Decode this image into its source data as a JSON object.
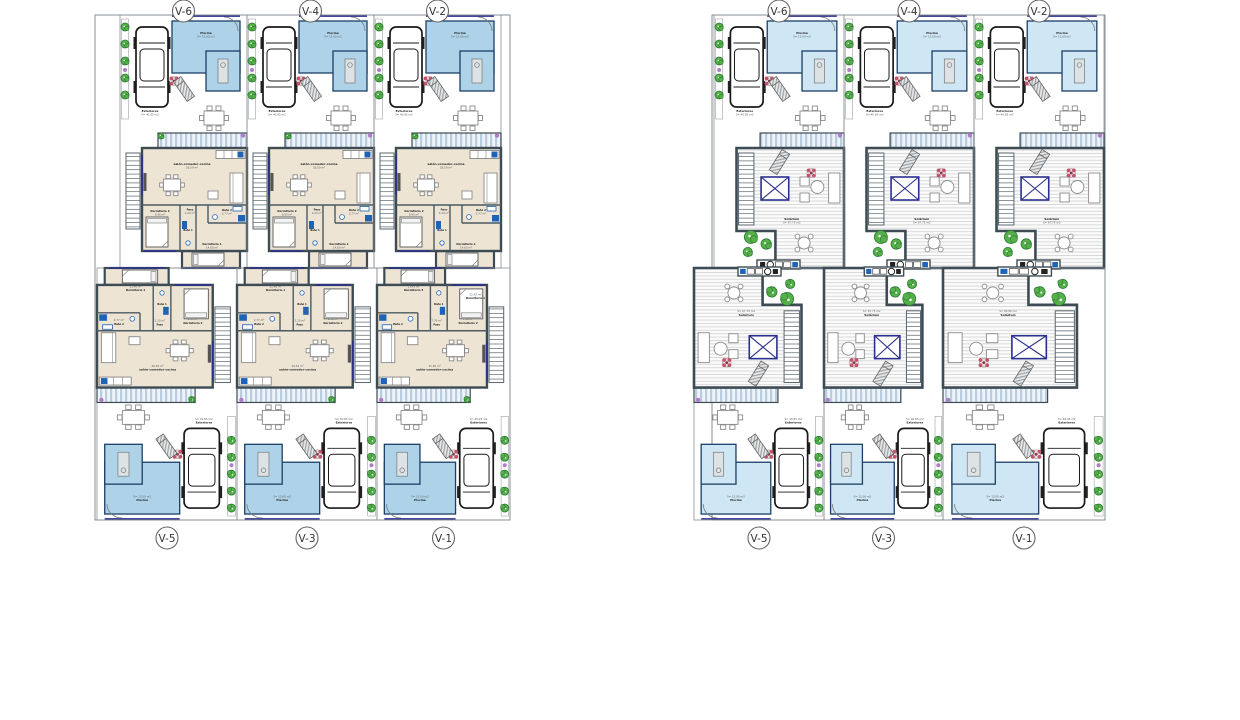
{
  "colors": {
    "boundary": "#8a8f94",
    "wall": "#3c4b54",
    "inner_wall": "#4a5a63",
    "floor": "#ede4d4",
    "pool_fill": "#aed3e8",
    "pool_fill_light": "#cfe6f4",
    "pool_border": "#1b3f66",
    "blue_fixture": "#1f63b5",
    "blue_accent": "#2b2f8e",
    "green": "#55b04a",
    "green_dark": "#2c7a33",
    "purple": "#b07cc6",
    "flower_red": "#c4526a",
    "furn_stroke": "#8a8a8a",
    "label": "#1a1a1a",
    "label_area": "#5a5f66",
    "circle_stroke": "#666666"
  },
  "plans": {
    "ground": {
      "top_units": [
        {
          "label": "V-6",
          "rooms": {
            "piscina": {
              "name": "Piscina",
              "area": "S= 12.00 m2"
            },
            "exteriores": {
              "name": "Exteriores",
              "area": "S= 40.85 m2"
            },
            "salon": {
              "name": "salón-comedor-cocina",
              "area": "26,59 m²"
            },
            "paso": {
              "name": "Paso",
              "area": "2,20 m²"
            },
            "bano1": {
              "name": "Baño 1"
            },
            "bano2": {
              "name": "Baño 2",
              "area": "3,77 m²"
            },
            "dorm1": {
              "name": "Dormitorio 1",
              "area": "14,60 m²"
            },
            "dorm2": {
              "name": "Dormitorio 2",
              "area": "9,95 m²"
            }
          }
        },
        {
          "label": "V-4",
          "rooms": {
            "piscina": {
              "name": "Piscina",
              "area": "S= 12.00 m2"
            },
            "exteriores": {
              "name": "Exteriores",
              "area": "S= 40.85 m2"
            },
            "salon": {
              "name": "salón-comedor-cocina",
              "area": "26,59 m²"
            },
            "paso": {
              "name": "Paso",
              "area": "2,20 m²"
            },
            "bano1": {
              "name": "Baño 1"
            },
            "bano2": {
              "name": "Baño 2",
              "area": "3,77 m²"
            },
            "dorm1": {
              "name": "Dormitorio 1",
              "area": "14,60 m²"
            },
            "dorm2": {
              "name": "Dormitorio 2",
              "area": "9,95 m²"
            }
          }
        },
        {
          "label": "V-2",
          "rooms": {
            "piscina": {
              "name": "Piscina",
              "area": "S= 12.00 m2"
            },
            "exteriores": {
              "name": "Exteriores",
              "area": "S= 40.85 m2"
            },
            "salon": {
              "name": "salón-comedor-cocina",
              "area": "26,59 m²"
            },
            "paso": {
              "name": "Paso",
              "area": "2,20 m²"
            },
            "bano1": {
              "name": "Baño 1"
            },
            "bano2": {
              "name": "Baño 2",
              "area": "3,77 m²"
            },
            "dorm1": {
              "name": "Dormitorio 1",
              "area": "14,60 m²"
            },
            "dorm2": {
              "name": "Dormitorio 2",
              "area": "9,95 m²"
            }
          }
        }
      ],
      "bottom_units": [
        {
          "label": "V-5",
          "rooms": {
            "piscina": {
              "name": "Piscina",
              "area": "S= 12.00 m2"
            },
            "exteriores": {
              "name": "Exteriores",
              "area": "S= 40.85 m2"
            },
            "salon": {
              "name": "salón-comedor-cocina",
              "area": "26,59 m²"
            },
            "paso": {
              "name": "Paso",
              "area": "2,20 m²"
            },
            "bano1": {
              "name": "Baño 1"
            },
            "bano2": {
              "name": "Baño 2",
              "area": "2,77 m²"
            },
            "dorm1": {
              "name": "Dormitorio 1",
              "area": "11,46 m²"
            },
            "dorm2": {
              "name": "Dormitorio 2",
              "area": "9,95 m²"
            }
          }
        },
        {
          "label": "V-3",
          "rooms": {
            "piscina": {
              "name": "Piscina",
              "area": "S= 12.00 m2"
            },
            "exteriores": {
              "name": "Exteriores",
              "area": "S= 40.85 m2"
            },
            "salon": {
              "name": "salón-comedor-cocina",
              "area": "26,59 m²"
            },
            "paso": {
              "name": "Paso",
              "area": "2,20 m²"
            },
            "bano1": {
              "name": "Baño 1"
            },
            "bano2": {
              "name": "Baño 2",
              "area": "2,77 m²"
            },
            "dorm1": {
              "name": "Dormitorio 1",
              "area": "11,46 m²"
            },
            "dorm2": {
              "name": "Dormitorio 2",
              "area": "9,95 m²"
            }
          }
        },
        {
          "label": "V-1",
          "variant": "wide",
          "rooms": {
            "piscina": {
              "name": "Piscina",
              "area": "S= 12.00 m2"
            },
            "exteriores": {
              "name": "Exteriores",
              "area": "S= 48.28 m2"
            },
            "salon": {
              "name": "salón-comedor-cocina",
              "area": "31,56 m²"
            },
            "paso": {
              "name": "Paso",
              "area": "7,76 m²"
            },
            "bano1": {
              "name": "Baño 1"
            },
            "bano2": {
              "name": "Baño 2"
            },
            "dorm1": {
              "name": "Dormitorio 1",
              "area": "12,42 m²"
            },
            "dorm2": {
              "name": "Dormitorio 2",
              "area": "7,51 m²"
            },
            "dorm3": {
              "name": "Dormitorio 3",
              "area": "11,42 m²"
            }
          }
        }
      ]
    },
    "solarium": {
      "top_units": [
        {
          "label": "V-6",
          "rooms": {
            "piscina": {
              "name": "Piscina",
              "area": "S= 12.00 m2"
            },
            "exteriores": {
              "name": "Exteriores",
              "area": "S= 40.85 m2"
            },
            "solarium": {
              "name": "Solárium",
              "area": "S= 67.75 m2"
            }
          }
        },
        {
          "label": "V-4",
          "rooms": {
            "piscina": {
              "name": "Piscina",
              "area": "S= 12.00 m2"
            },
            "exteriores": {
              "name": "Exteriores",
              "area": "S= 40.85 m2"
            },
            "solarium": {
              "name": "Solárium",
              "area": "S= 67.75 m2"
            }
          }
        },
        {
          "label": "V-2",
          "rooms": {
            "piscina": {
              "name": "Piscina",
              "area": "S= 12.00 m2"
            },
            "exteriores": {
              "name": "Exteriores",
              "area": "S= 40.85 m2"
            },
            "solarium": {
              "name": "Solárium",
              "area": "S= 67.75 m2"
            }
          }
        }
      ],
      "bottom_units": [
        {
          "label": "V-5",
          "rooms": {
            "piscina": {
              "name": "Piscina",
              "area": "S= 12.00 m2"
            },
            "exteriores": {
              "name": "Exteriores",
              "area": "S= 40.85 m2"
            },
            "solarium": {
              "name": "Solárium",
              "area": "S= 67.75 m2"
            }
          }
        },
        {
          "label": "V-3",
          "rooms": {
            "piscina": {
              "name": "Piscina",
              "area": "S= 12.00 m2"
            },
            "exteriores": {
              "name": "Exteriores",
              "area": "S= 40.85 m2"
            },
            "solarium": {
              "name": "Solárium",
              "area": "S= 67.75 m2"
            }
          }
        },
        {
          "label": "V-1",
          "variant": "wide",
          "rooms": {
            "piscina": {
              "name": "Piscina",
              "area": "S= 12.00 m2"
            },
            "exteriores": {
              "name": "Exteriores",
              "area": "S= 48.28 m2"
            },
            "solarium": {
              "name": "Solárium",
              "area": "S= 83.86 m2"
            }
          }
        }
      ]
    }
  }
}
